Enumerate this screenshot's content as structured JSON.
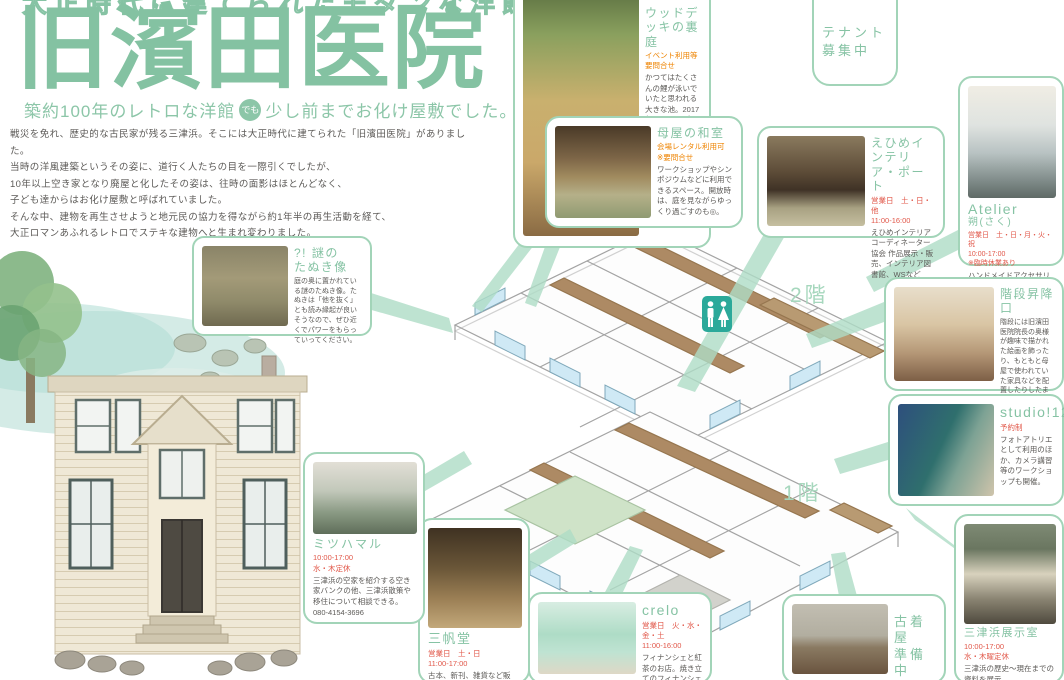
{
  "header": {
    "top_caption": "大正時代に建てられたモダンな洋館",
    "title": "旧濱田医院",
    "subtitle_pre": "築約100年のレトロな洋館",
    "subtitle_badge": "でも",
    "subtitle_post": "少し前までお化け屋敷でした。"
  },
  "intro": {
    "line1": "戦災を免れ、歴史的な古民家が残る三津浜。そこには大正時代に建てられた「旧濱田医院」がありました。",
    "line2": "当時の洋風建築というその姿に、道行く人たちの目を一際引くでしたが、",
    "line3": "10年以上空き家となり廃屋と化したその姿は、往時の面影はほとんどなく、",
    "line4": "子ども達からはお化け屋敷と呼ばれていました。",
    "line5": "そんな中、建物を再生させようと地元民の協力を得ながら約1年半の再生活動を経て、",
    "line6": "大正ロマンあふれるレトロでステキな建物へと生まれ変わりました。"
  },
  "map": {
    "floor2_label": "2階",
    "floor1_label": "1階"
  },
  "cards": {
    "wood_deck": {
      "title": "ウッドデッキの裏庭",
      "note": "イベント利用等要問合せ",
      "body": "かつてはたくさんの鯉が泳いでいたと思われる大きな池。2017年にウッドデッキを造り、みんなの憩いの場として使用しています。"
    },
    "tenant": {
      "title": "テナント募集中"
    },
    "washitsu": {
      "title": "母屋の和室",
      "note": "会場レンタル利用可",
      "note2": "※要問合せ",
      "body": "ワークショップやシンポジウムなどに利用できるスペース。開放時は、庭を見ながらゆっくり過ごすのも◎。"
    },
    "ehime_interior": {
      "title": "えひめインテリア・ポート",
      "schedule": "営業日　土・日・他",
      "hours": "11:00-16:00",
      "body": "えひめインテリアコーディネーター協会 作品展示・販売、インテリア図書館、WSなど"
    },
    "atelier": {
      "title": "Atelier",
      "subtitle": "朔(さく)",
      "schedule": "営業日　土・日・月・火・祝",
      "hours": "10:00-17:00",
      "note": "※臨時休業あり",
      "body": "ハンドメイドアクセサリーの制作販売。"
    },
    "stairs": {
      "title": "階段昇降口",
      "body": "階段には旧濱田医院院長の奥様が趣味で描かれた絵画を飾ったり、もともと母屋で使われていた家具などを配置したりしたまったりスペース。休憩などにご利用ください。"
    },
    "studio125": {
      "title": "studio!125",
      "note": "予約制",
      "body": "フォトアトリエとして利用のほか、カメラ講習等のワークショップも開催。"
    },
    "exhibit": {
      "title": "三津浜展示室",
      "hours": "10:00-17:00",
      "closed": "水・木曜定休",
      "body": "三津浜の歴史〜現在までの資料を展示",
      "phone": "080-4154-3696"
    },
    "furugiya": {
      "title_line1": "古着屋",
      "title_line2": "準備中"
    },
    "crelo": {
      "title": "crelo",
      "schedule": "営業日　火・水・金・土",
      "hours": "11:00-16:00",
      "body": "フィナンシェと紅茶のお店。焼き立てのフィナンシェも数量限定で販売。"
    },
    "sanpodo": {
      "title": "三帆堂",
      "schedule": "営業日　土・日",
      "hours": "11:00-17:00",
      "body": "古本、新刊、雑貨など販売。三津浜地区内や、他地区で本"
    },
    "mitsuhamaru": {
      "title": "ミツハマル",
      "hours": "10:00-17:00",
      "closed": "水・木定休",
      "body": "三津浜の空家を紹介する空き家バンクの他、三津浜散策や移住について相談できる。",
      "phone": "080-4154-3696"
    },
    "tanuki": {
      "title_prefix": "?! 謎の",
      "title": "たぬき像",
      "body": "庭の奥に置かれている謎のたぬき像。たぬきは「他を抜く」とも読み縁起が良いそうなので、ぜひ近くでパワーをもらっていってください。"
    }
  },
  "colors": {
    "accent_green": "#84c2a2",
    "card_border_green": "#a2d4b8",
    "ribbon_green": "#aedcc6",
    "note_red": "#e15749",
    "note_orange": "#ee8300",
    "body_gray": "#5c5a57",
    "restroom_teal": "#2ba99a"
  }
}
